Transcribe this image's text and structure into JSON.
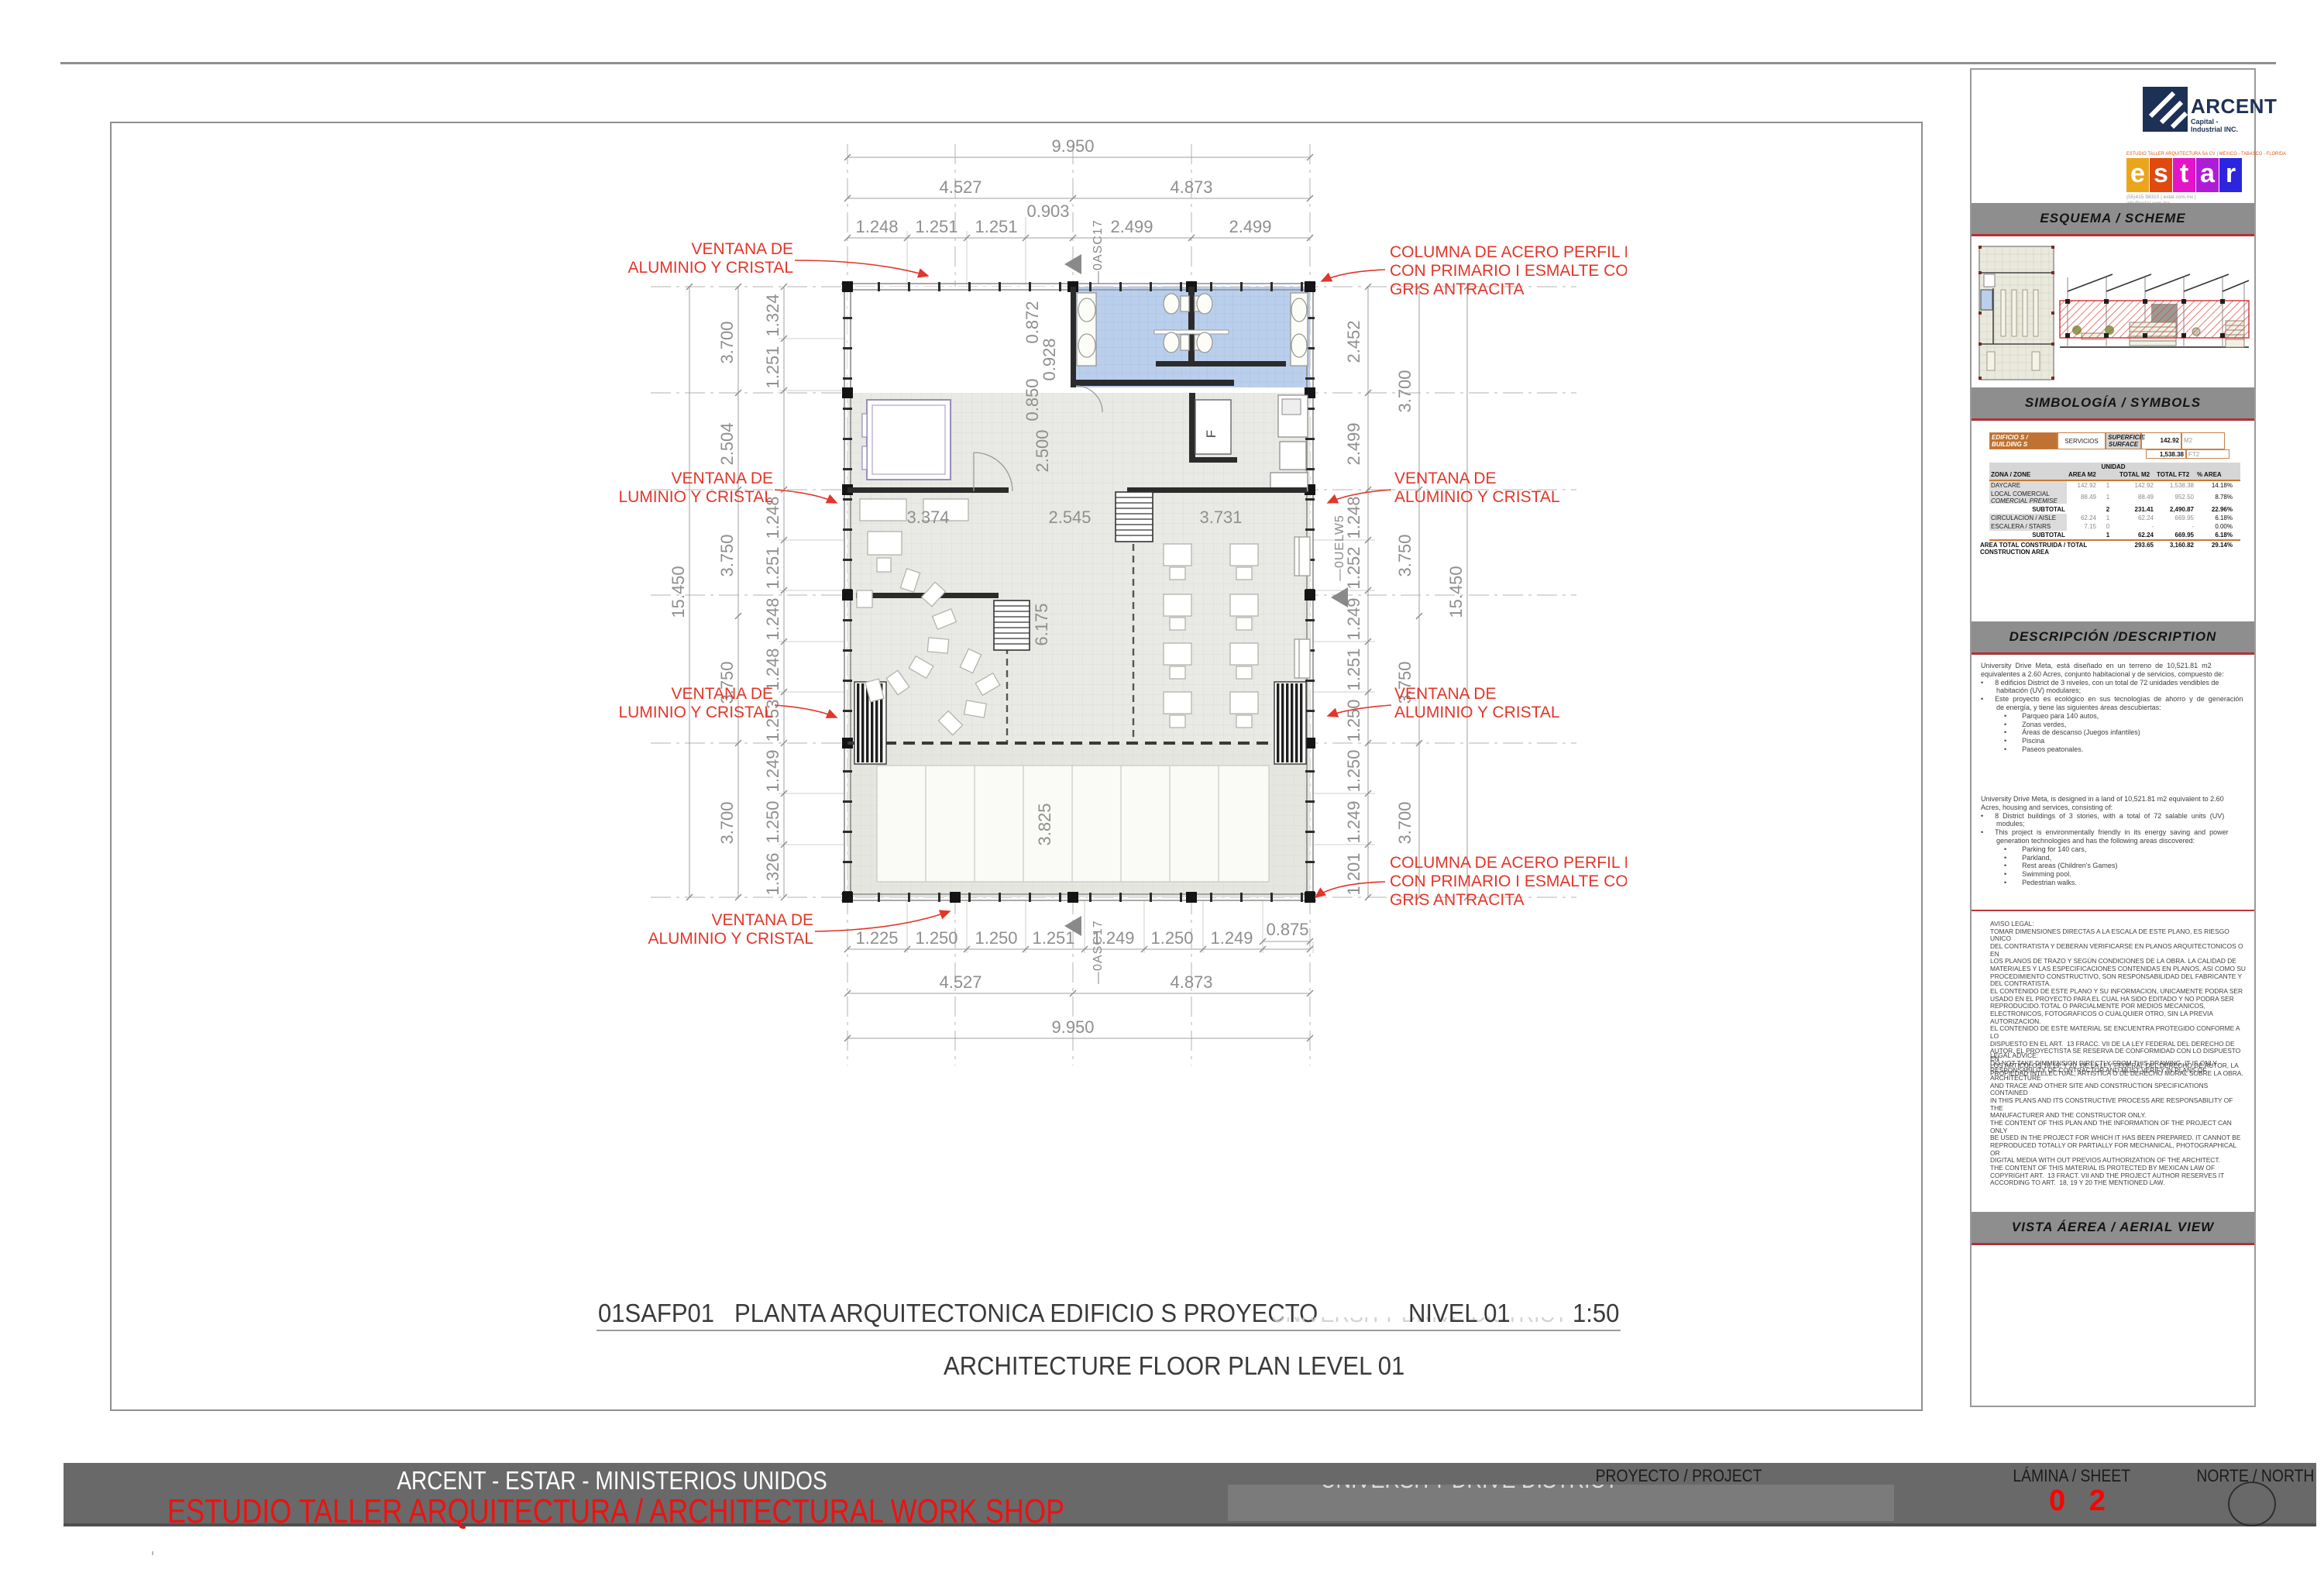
{
  "page": {
    "sheet_code": "01SAFP01",
    "title_es": "PLANTA ARQUITECTONICA EDIFICIO S  PROYECTO",
    "faint_project": "UNIVERSITY DRIVE DISTRICT",
    "title_level": "NIVEL 01",
    "title_scale": "1:50",
    "title_en": "ARCHITECTURE FLOOR PLAN LEVEL 01"
  },
  "footer": {
    "line1": "ARCENT - ESTAR - MINISTERIOS UNIDOS",
    "line2": "ESTUDIO TALLER ARQUITECTURA  / ARCHITECTURAL WORK SHOP",
    "project_label": "PROYECTO / PROJECT",
    "project_value": "UNIVERSITY DRIVE DISTRICT",
    "sheet_label": "LÁMINA / SHEET",
    "sheet_number": "0 2",
    "north_label": "NORTE / NORTH"
  },
  "sidebar": {
    "arcent": {
      "name": "ARCENT",
      "tagline": "Capital - Industrial INC.",
      "navy": "#1d3157"
    },
    "estar": {
      "top_line": "ESTUDIO TALLER ARQUITECTURA SA CV | MÉXICO  -  TABASCO  -  FLORIDA",
      "letters": [
        "e",
        "s",
        "t",
        "a",
        "r"
      ],
      "colors": [
        "#EBA51C",
        "#E0490F",
        "#E414C9",
        "#B01BD8",
        "#2B25DF"
      ],
      "contact1": "(55)415  98310    |    estar.com.mx  |",
      "contact2": "info@estar.com.mx"
    },
    "sections": {
      "scheme": "ESQUEMA / SCHEME",
      "symbols": "SIMBOLOGÍA / SYMBOLS",
      "description": "DESCRIPCIÓN /DESCRIPTION",
      "aerial": "VISTA  ÁEREA / AERIAL VIEW"
    },
    "table": {
      "building_label": "EDIFICIO S / BUILDING S",
      "building_type": "SERVICIOS",
      "surface_label": "SUPERFICIE\nSURFACE",
      "surface_m2": "142.92",
      "surface_m2_unit": "M2",
      "surface_ft2": "1,538.38",
      "surface_ft2_unit": "FT2",
      "unidad": "UNIDAD",
      "h_zone": "ZONA / ZONE",
      "h_area": "AREA M2",
      "h_tm2": "TOTAL M2",
      "h_tft2": "TOTAL FT2",
      "h_pct": "% AREA",
      "rows": [
        {
          "zone": "DAYCARE",
          "zone2": "",
          "area": "142.92",
          "unit": "1",
          "tm2": "142.92",
          "tft2": "1,538.38",
          "pct": "14.18%"
        },
        {
          "zone": "LOCAL COMERCIAL",
          "zone2": "COMERCIAL PREMISE",
          "area": "88.49",
          "unit": "1",
          "tm2": "88.49",
          "tft2": "952.50",
          "pct": "8.78%"
        },
        {
          "zone": "SUBTOTAL",
          "zone2": "",
          "area": "",
          "unit": "2",
          "tm2": "231.41",
          "tft2": "2,490.87",
          "pct": "22.96%"
        },
        {
          "zone": "CIRCULACION  / AISLE",
          "zone2": "",
          "area": "62.24",
          "unit": "1",
          "tm2": "62.24",
          "tft2": "669.95",
          "pct": "6.18%"
        },
        {
          "zone": "ESCALERA / STAIRS",
          "zone2": "",
          "area": "7.15",
          "unit": "0",
          "tm2": "-",
          "tft2": "-",
          "pct": "0.00%"
        },
        {
          "zone": "SUBTOTAL",
          "zone2": "",
          "area": "",
          "unit": "1",
          "tm2": "62.24",
          "tft2": "669.95",
          "pct": "6.18%"
        }
      ],
      "total_label": "AREA TOTAL CONSTRUIDA  / TOTAL CONSTRUCTION AREA",
      "total_m2": "293.65",
      "total_ft2": "3,160.82",
      "total_pct": "29.14%"
    },
    "description_es": "University  Drive  Meta,  está  diseñado  en  un  terreno  de  10,521.81  m2\nequivalentes a 2.60 Acres, conjunto habitacional y de servicios, compuesto de:\n•      8 edificios District de 3 niveles, con un total de 72 unidades vendibles de\n        habitación (UV) modulares;\n•      Este  proyecto  es  ecológico  en  sus  tecnologías  de  ahorro  y  de  generación\n        de energía, y tiene las siguientes áreas descubiertas:\n            •        Parqueo para 140 autos,\n            •        Zonas verdes,\n            •        Áreas de descanso (Juegos infantiles)\n            •        Piscina\n            •        Paseos peatonales.",
    "description_en": "University Drive Meta, is designed in a land of 10,521.81 m2 equivalent to 2.60\nAcres, housing and services, consisting of:\n•      8  District  buildings  of  3  stories,  with  a  total  of  72  salable  units  (UV)\n        modules;\n•      This  project  is  environmentally  friendly  in  its  energy  saving  and  power\n        generation technologies and has the following areas discovered:\n            •        Parking for 140 cars,\n            •        Parkland,\n            •        Rest areas (Children's Games)\n            •        Swimming pool.\n            •        Pedestrian walks.",
    "legal_es": "AVISO LEGAL:\nTOMAR DIMENSIONES DIRECTAS A LA ESCALA DE ESTE PLANO, ES RIESGO UNICO\nDEL CONTRATISTA Y DEBERAN VERIFICARSE EN PLANOS ARQUITECTONICOS O EN\nLOS PLANOS DE TRAZO Y SEGÚN CONDICIONES DE LA OBRA. LA CALIDAD DE\nMATERIALES Y LAS ESPECIFICACIONES CONTENIDAS EN PLANOS, ASI COMO SU\nPROCEDIMIENTO CONSTRUCTIVO, SON RESPONSABILIDAD DEL FABRICANTE Y\nDEL CONTRATISTA.\nEL CONTENIDO DE ESTE PLANO Y SU INFORMACION, UNICAMENTE PODRA SER\nUSADO EN EL PROYECTO PARA EL CUAL HA SIDO EDITADO Y NO PODRA SER\nREPRODUCIDO.TOTAL O PARCIALMENTE POR MEDIOS MECANICOS,\nELECTRONICOS, FOTOGRAFICOS O CUALQUIER OTRO, SIN LA PREVIA\nAUTORIZACION.\nEL CONTENIDO DE ESTE MATERIAL SE ENCUENTRA PROTEGIDO CONFORME A LO\nDISPUESTO EN EL ART.  13 FRACC. VII DE LA LEY FEDERAL DEL DERECHO DE\nAUTOR. EL PROYECTISTA SE RESERVA DE CONFORMIDAD CON LO DISPUESTO EN\nLOS ARTICULOS 18,19, Y 20  DE LA LEY FEDERAL DEL DERECHO DE AUTOR, LA\nPROPIEDAD INTELECTUAL, ARTISTICA O DE DERECHO MORAL SOBRE LA OBRA.",
    "legal_en": "LEGAL ADVICE:\nDO NOT TAKE DIMMENSION DIRECTLY FROM THIS DRAWING, IT IS ONLY\nRESPONSABILITY OF CONTRACTOR AND MUST VERIFY IN PLANS OF\nARCHITECTURE\nAND TRACE AND OTHER SITE AND CONSTRUCTION SPECIFICATIONS CONTAINED\nIN THIS PLANS AND ITS CONSTRUCTIVE PROCESS ARE RESPONSABILITY OF THE\nMANUFACTURER AND THE CONSTRUCTOR ONLY.\nTHE CONTENT OF THIS PLAN AND THE INFORMATION OF THE PROJECT CAN ONLY\nBE USED IN THE PROJECT FOR WHICH IT HAS BEEN PREPARED. IT CANNOT BE\nREPRODUCED TOTALLY OR PARTIALLY FOR MECHANICAL, PHOTOGRAPHICAL OR\nDIGITAL MEDIA WITH OUT PREVIOS AUTHORIZATION OF THE ARCHITECT.\nTHE CONTENT OF THIS MATERIAL IS PROTECTED BY MEXICAN LAW OF\nCOPYRIGHT ART.  13 FRACT. VII AND THE PROJECT AUTHOR RESERVES IT\nACCORDING TO ART.  18, 19 Y 20 THE MENTIONED LAW."
  },
  "plan": {
    "window_l1": "VENTANA DE",
    "window_l2": "ALUMINIO Y CRISTAL",
    "column_l1": "COLUMNA DE ACERO PERFIL HSS",
    "column_l2": "CON PRIMARIO I ESMALTE COLOR",
    "column_l3": "GRIS ANTRACITA",
    "marker_asc": "—0ASC17",
    "marker_uelw": "—0UELW5",
    "top_total": "9.950",
    "top_a": "4.527",
    "top_b": "4.873",
    "top_offset": "0.903",
    "top_chain": [
      "1.248",
      "1.251",
      "1.251",
      "2.499",
      "2.499"
    ],
    "bottom_chain": [
      "1.225",
      "1.250",
      "1.250",
      "1.251",
      "1.249",
      "1.250",
      "1.249"
    ],
    "bottom_offset": "0.875",
    "bottom_a": "4.527",
    "bottom_b": "4.873",
    "bottom_total": "9.950",
    "left_total": "15.450",
    "left_mid": [
      "3.700",
      "2.504",
      "3.750",
      "3.750",
      "3.700"
    ],
    "left_chain": [
      "1.324",
      "1.251",
      "1.248",
      "1.251",
      "1.248",
      "1.248",
      "1.253",
      "1.249",
      "1.250",
      "1.326"
    ],
    "right_total": "15.450",
    "right_mid": [
      "3.700",
      "3.750",
      "3.750",
      "3.700"
    ],
    "right_chain": [
      "2.452",
      "2.499",
      "1.248",
      "1.252",
      "1.249",
      "1.251",
      "1.250",
      "1.250",
      "1.249",
      "1.201"
    ],
    "inner": {
      "a": "0.872",
      "b": "0.928",
      "c": "0.850",
      "d": "2.500",
      "e": "3.374",
      "f": "2.545",
      "g": "3.731",
      "h": "6.175",
      "i": "3.825"
    },
    "kitchen_f": "F"
  }
}
